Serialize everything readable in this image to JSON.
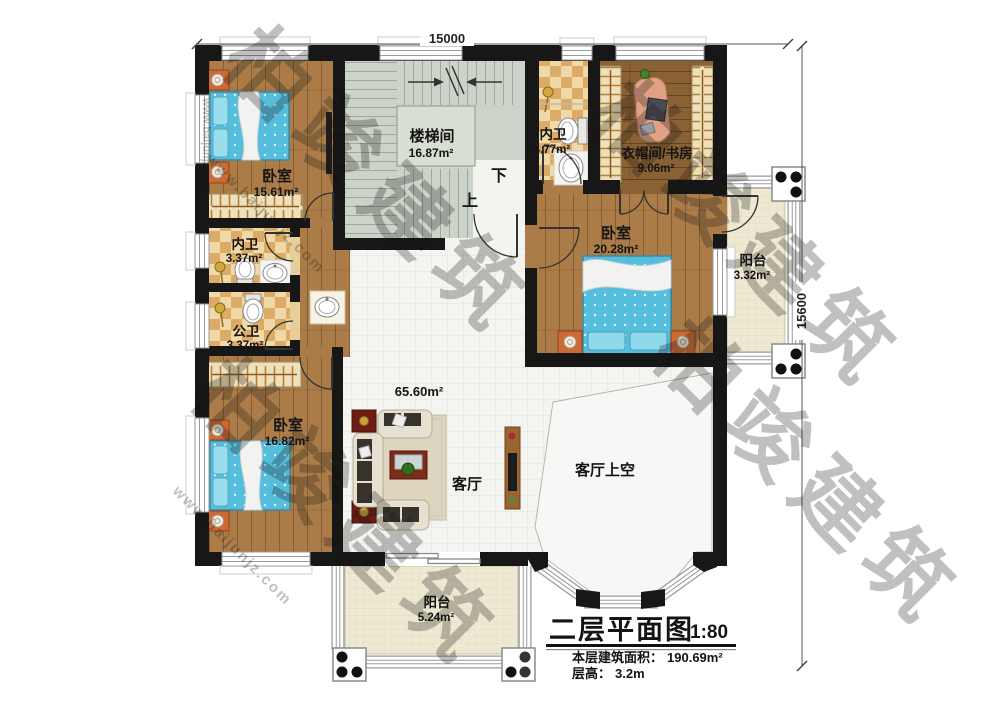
{
  "plan": {
    "dimensions": {
      "width": "15000",
      "height": "15600"
    },
    "rooms": {
      "bedroom_top_left": {
        "name": "卧室",
        "area": "15.61m²"
      },
      "stairwell": {
        "name": "楼梯间",
        "area": "16.87m²"
      },
      "bath_ensuite_top": {
        "name": "内卫",
        "area": "4.77m²"
      },
      "cloakroom_study": {
        "name": "衣帽间/书房",
        "area": "9.06m²"
      },
      "bedroom_right": {
        "name": "卧室",
        "area": "20.28m²"
      },
      "balcony_right": {
        "name": "阳台",
        "area": "3.32m²"
      },
      "bath_ensuite_left": {
        "name": "内卫",
        "area": "3.37m²"
      },
      "bath_public": {
        "name": "公卫",
        "area": "3.37m²"
      },
      "bedroom_bottom_left": {
        "name": "卧室",
        "area": "16.82m²"
      },
      "living_room": {
        "name": "客厅",
        "area": "65.60m²"
      },
      "living_void": {
        "name": "客厅上空"
      },
      "balcony_bottom": {
        "name": "阳台",
        "area": "5.24m²"
      }
    },
    "stair_labels": {
      "down": "下",
      "up": "上"
    }
  },
  "title_block": {
    "title": "二层平面图",
    "scale": "1:80",
    "floor_area_label": "本层建筑面积：",
    "floor_area_value": "190.69m²",
    "floor_height_label": "层高：",
    "floor_height_value": "3.2m"
  },
  "watermark": {
    "brand": "柏竣建筑",
    "url": "www.baijunjz.com"
  },
  "colors": {
    "wall": "#171717",
    "wood_floor": "#ab7c48",
    "study_floor": "#8a6134",
    "tile_floor": "#f4f4f1",
    "bath_tile_light": "#f0d9a8",
    "bath_tile_dark": "#dcab66",
    "stair_floor": "#ccd3c8",
    "balcony_floor": "#efe9d3",
    "bed": "#55bedd",
    "nightstand": "#cd6a33"
  }
}
